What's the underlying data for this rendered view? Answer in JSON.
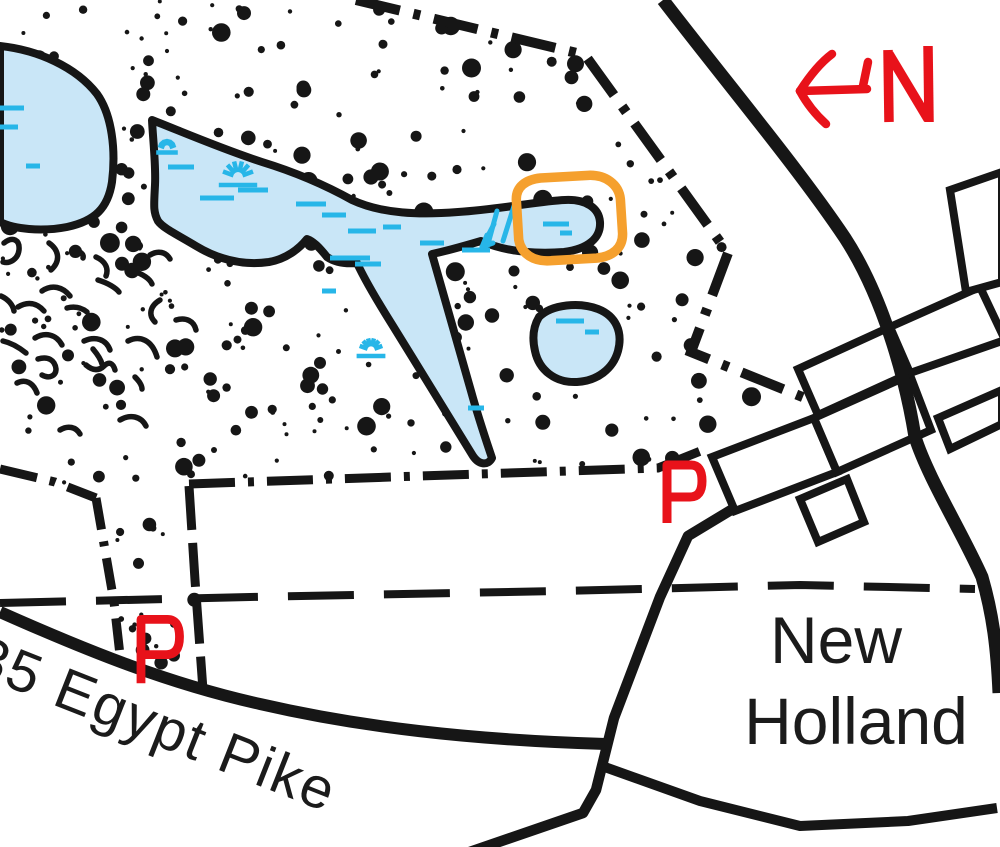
{
  "map": {
    "colors": {
      "ink": "#161616",
      "water_fill": "#c9e6f7",
      "marsh": "#27b6e8",
      "highlight": "#f5a02e",
      "annotation": "#e8121a",
      "label": "#1b1b1b"
    },
    "labels": {
      "town_line1": "New",
      "town_line2": "Holland",
      "road_name": "35 Egypt Pike",
      "north": "N",
      "parking": "P"
    },
    "town_label": {
      "line1": {
        "x": 836,
        "y": 663
      },
      "line2": {
        "x": 856,
        "y": 744
      },
      "font_size": 66
    },
    "road_label": {
      "x": -30,
      "y": 672,
      "angle": 21.5,
      "font_size": 58
    },
    "water": [
      {
        "name": "west-lake",
        "d": "M0,46 C38,50 76,67 97,94 C112,115 116,150 112,182 C108,208 95,221 67,227 C41,232 14,229 0,222 Z"
      },
      {
        "name": "main-pond",
        "d": "M152,120 C185,133 222,149 262,162 C298,173 325,185 352,200 C382,214 420,215 458,212 C502,209 540,201 565,200 C586,199 599,208 600,222 C601,238 588,249 564,252 C536,254 506,252 481,241 C464,246 447,251 432,254 C443,292 457,342 471,391 C479,420 488,446 492,458 C488,466 479,465 473,456 C451,421 421,371 393,326 C376,299 363,276 357,263 C346,264 336,263 327,257 C319,247 313,241 307,239 C299,249 286,259 269,262 C241,266 216,258 196,246 C176,234 163,228 158,221 C153,212 154,205 155,185 C156,165 153,140 152,120 Z"
      },
      {
        "name": "small-pond",
        "d": "M539,317 C552,304 580,302 598,309 C616,316 623,332 618,351 C613,369 597,381 577,382 C555,383 539,370 535,351 C532,338 533,327 539,317 Z"
      }
    ],
    "marsh_dashes": [
      [
        168,
        167,
        26
      ],
      [
        200,
        198,
        34
      ],
      [
        238,
        190,
        30
      ],
      [
        296,
        204,
        30
      ],
      [
        322,
        215,
        24
      ],
      [
        348,
        231,
        28
      ],
      [
        383,
        227,
        18
      ],
      [
        330,
        258,
        40
      ],
      [
        355,
        264,
        26
      ],
      [
        420,
        243,
        24
      ],
      [
        462,
        250,
        28
      ],
      [
        543,
        224,
        26
      ],
      [
        560,
        233,
        12
      ],
      [
        556,
        321,
        28
      ],
      [
        585,
        332,
        14
      ],
      [
        0,
        108,
        24
      ],
      [
        0,
        127,
        18
      ],
      [
        26,
        166,
        14
      ],
      [
        322,
        291,
        14
      ],
      [
        468,
        408,
        16
      ],
      [
        880,
        345,
        0
      ]
    ],
    "tussocks": [
      [
        238,
        177,
        16
      ],
      [
        167,
        148,
        9
      ],
      [
        371,
        350,
        12
      ]
    ],
    "flow_arrow": [
      "M514,206 L503,241",
      "M497,211 L488,244",
      "M494,224 L482,247",
      "M482,247 L487,235",
      "M482,247 L493,243"
    ],
    "boundaries": [
      {
        "d": "M0,469 L55,482 L96,498",
        "dash": "38 13 6 13",
        "w": 9
      },
      {
        "d": "M96,498 L114,602 L121,664",
        "dash": "32 12 5 12",
        "w": 9
      },
      {
        "d": "M189,484 L420,476 L658,468 L703,450",
        "dash": "46 13 6 13",
        "w": 9
      },
      {
        "d": "M189,486 L195,580 L203,690",
        "dash": "44 13",
        "w": 9
      },
      {
        "d": "M356,0 L585,55 L728,253 L691,352 L882,429",
        "dash": "45 14 7 14",
        "w": 10
      }
    ],
    "trail": {
      "d": "M0,603 L250,597 L560,591 L800,585 L975,589",
      "dash": "66 30",
      "w": 8
    },
    "roads": [
      {
        "name": "north-road",
        "d": "M663,0 C726,82 798,168 845,238 C882,295 905,375 915,437 C928,478 962,532 982,577 C993,615 997,648 999,693",
        "w": 13
      },
      {
        "name": "cross-road",
        "d": "M736,507 L688,536 L660,597 L614,718 L596,790 L583,813 L458,856",
        "w": 10.5
      },
      {
        "name": "east-branch-road",
        "d": "M602,766 L700,801 L800,826 L908,821 L997,808",
        "w": 10
      },
      {
        "name": "egypt-pike-road",
        "d": "M0,612 C90,652 170,684 260,704 C360,727 470,740 606,744",
        "w": 12
      }
    ],
    "blocks": [
      "712,457 814,418 837,472 735,511",
      "814,418 910,375 931,430 837,472",
      "798,369 890,327 910,373 818,415",
      "890,327 980,287 1005,340 910,373",
      "800,499 847,479 864,522 818,542",
      "938,418 1002,390 1002,424 950,449",
      "950,190 1002,172 1002,282 966,292"
    ],
    "squiggles": [
      "M4,243 C13,236 20,240 19,250 C18,259 10,264 3,262",
      "M49,243 C59,250 61,261 51,270",
      "M75,251 C80,251 84,254 83,258",
      "M96,257 C105,261 109,268 106,276",
      "M42,291 C52,284 63,287 70,296",
      "M1,296 C8,299 13,305 14,311",
      "M18,307 C28,301 37,303 44,311",
      "M67,308 C75,306 82,308 87,312",
      "M98,280 C108,283 116,288 119,292",
      "M133,271 C143,274 150,279 152,284",
      "M35,338 C45,332 56,334 62,345",
      "M3,341 C12,343 21,349 26,353",
      "M38,359 C48,356 55,360 56,369 C56,376 49,379 42,375",
      "M84,341 C95,336 106,339 110,350",
      "M93,349 C98,355 101,360 102,364",
      "M128,341 C140,335 152,340 157,357",
      "M86,365 C93,371 99,371 104,366 C109,361 113,363 115,370",
      "M17,383 C25,379 33,382 37,393",
      "M135,377 C139,381 142,385 142,389",
      "M160,300 C150,306 148,315 155,322",
      "M176,320 C186,317 194,321 196,330",
      "M150,255 C158,250 166,252 170,259",
      "M120,420 C130,414 141,416 146,426",
      "M60,430 C68,425 76,427 80,434"
    ],
    "stipple": {
      "seed": 1337,
      "regions": [
        {
          "poly": [
            [
              0,
              0
            ],
            [
              350,
              0
            ],
            [
              585,
              52
            ],
            [
              728,
              253
            ],
            [
              690,
              352
            ],
            [
              777,
              391
            ],
            [
              702,
              450
            ],
            [
              658,
              467
            ],
            [
              189,
              481
            ],
            [
              113,
              496
            ],
            [
              0,
              467
            ]
          ],
          "count": 330,
          "rmin": 2,
          "rmax": 10
        },
        {
          "poly": [
            [
              114,
              500
            ],
            [
              191,
              487
            ],
            [
              200,
              688
            ],
            [
              122,
              664
            ]
          ],
          "count": 18,
          "rmin": 2,
          "rmax": 7
        }
      ]
    },
    "highlight_ring": {
      "d": "M517,198 C517,185 527,178 542,177 L590,176 C607,176 620,186 621,201 L622,235 C622,250 611,258 595,259 L550,260 C532,261 520,252 518,238 Z",
      "w": 9.5,
      "rotate": "-2 570 218"
    },
    "north_arrow": {
      "strokes": [
        "M867,89 L800,91",
        "M863,86 L868,62",
        "M800,91 C809,77 820,63 832,54",
        "M800,91 C807,104 816,115 826,124"
      ],
      "letter_strokes": [
        "M889,122 L888,50",
        "M889,54 L928,119",
        "M929,122 L928,46"
      ],
      "w": 8.5,
      "letter_w": 9.5
    },
    "parking_glyph": "M0,2 L0,-56 L24,-56 Q35,-56 35,-40 Q35,-24 23,-24 L0,-24",
    "parking_markers": [
      {
        "transform": "translate(667,521)",
        "w": 9
      },
      {
        "transform": "translate(141,681) scale(1.1)",
        "w": 8
      }
    ]
  }
}
